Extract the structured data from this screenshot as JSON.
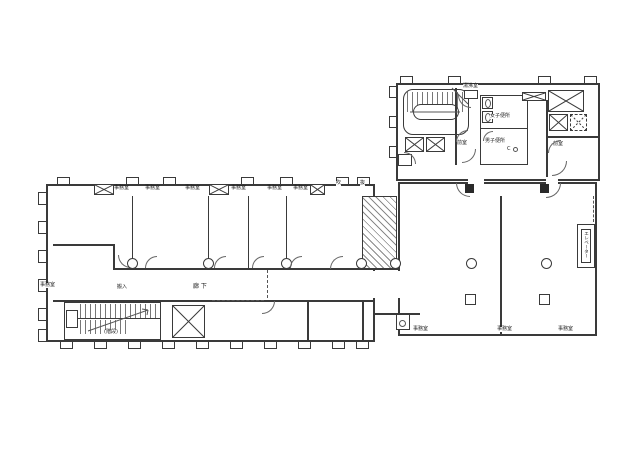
{
  "colors": {
    "ink": "#3a3a3a",
    "thin_line": "#666666",
    "paper": "#ffffff"
  },
  "upper_block": {
    "kettle_room": "湯沸室",
    "womens_toilet": "女子便所",
    "mens_toilet": "男子便所",
    "anteroom_left": "前室",
    "anteroom_right": "前室",
    "cleaner_mark": "C"
  },
  "main_wing": {
    "top_offices": [
      "事務室",
      "事務室",
      "事務室",
      "事務室",
      "事務室",
      "事務室"
    ],
    "left_office": "事務室",
    "corridor": "廊 下",
    "delivery": "搬入",
    "stairs": "(階段)",
    "void_left": "吹",
    "void_right": "抜"
  },
  "right_wing": {
    "offices": [
      "事務室",
      "事務室",
      "事務室"
    ],
    "elevator": "エレベーター"
  }
}
